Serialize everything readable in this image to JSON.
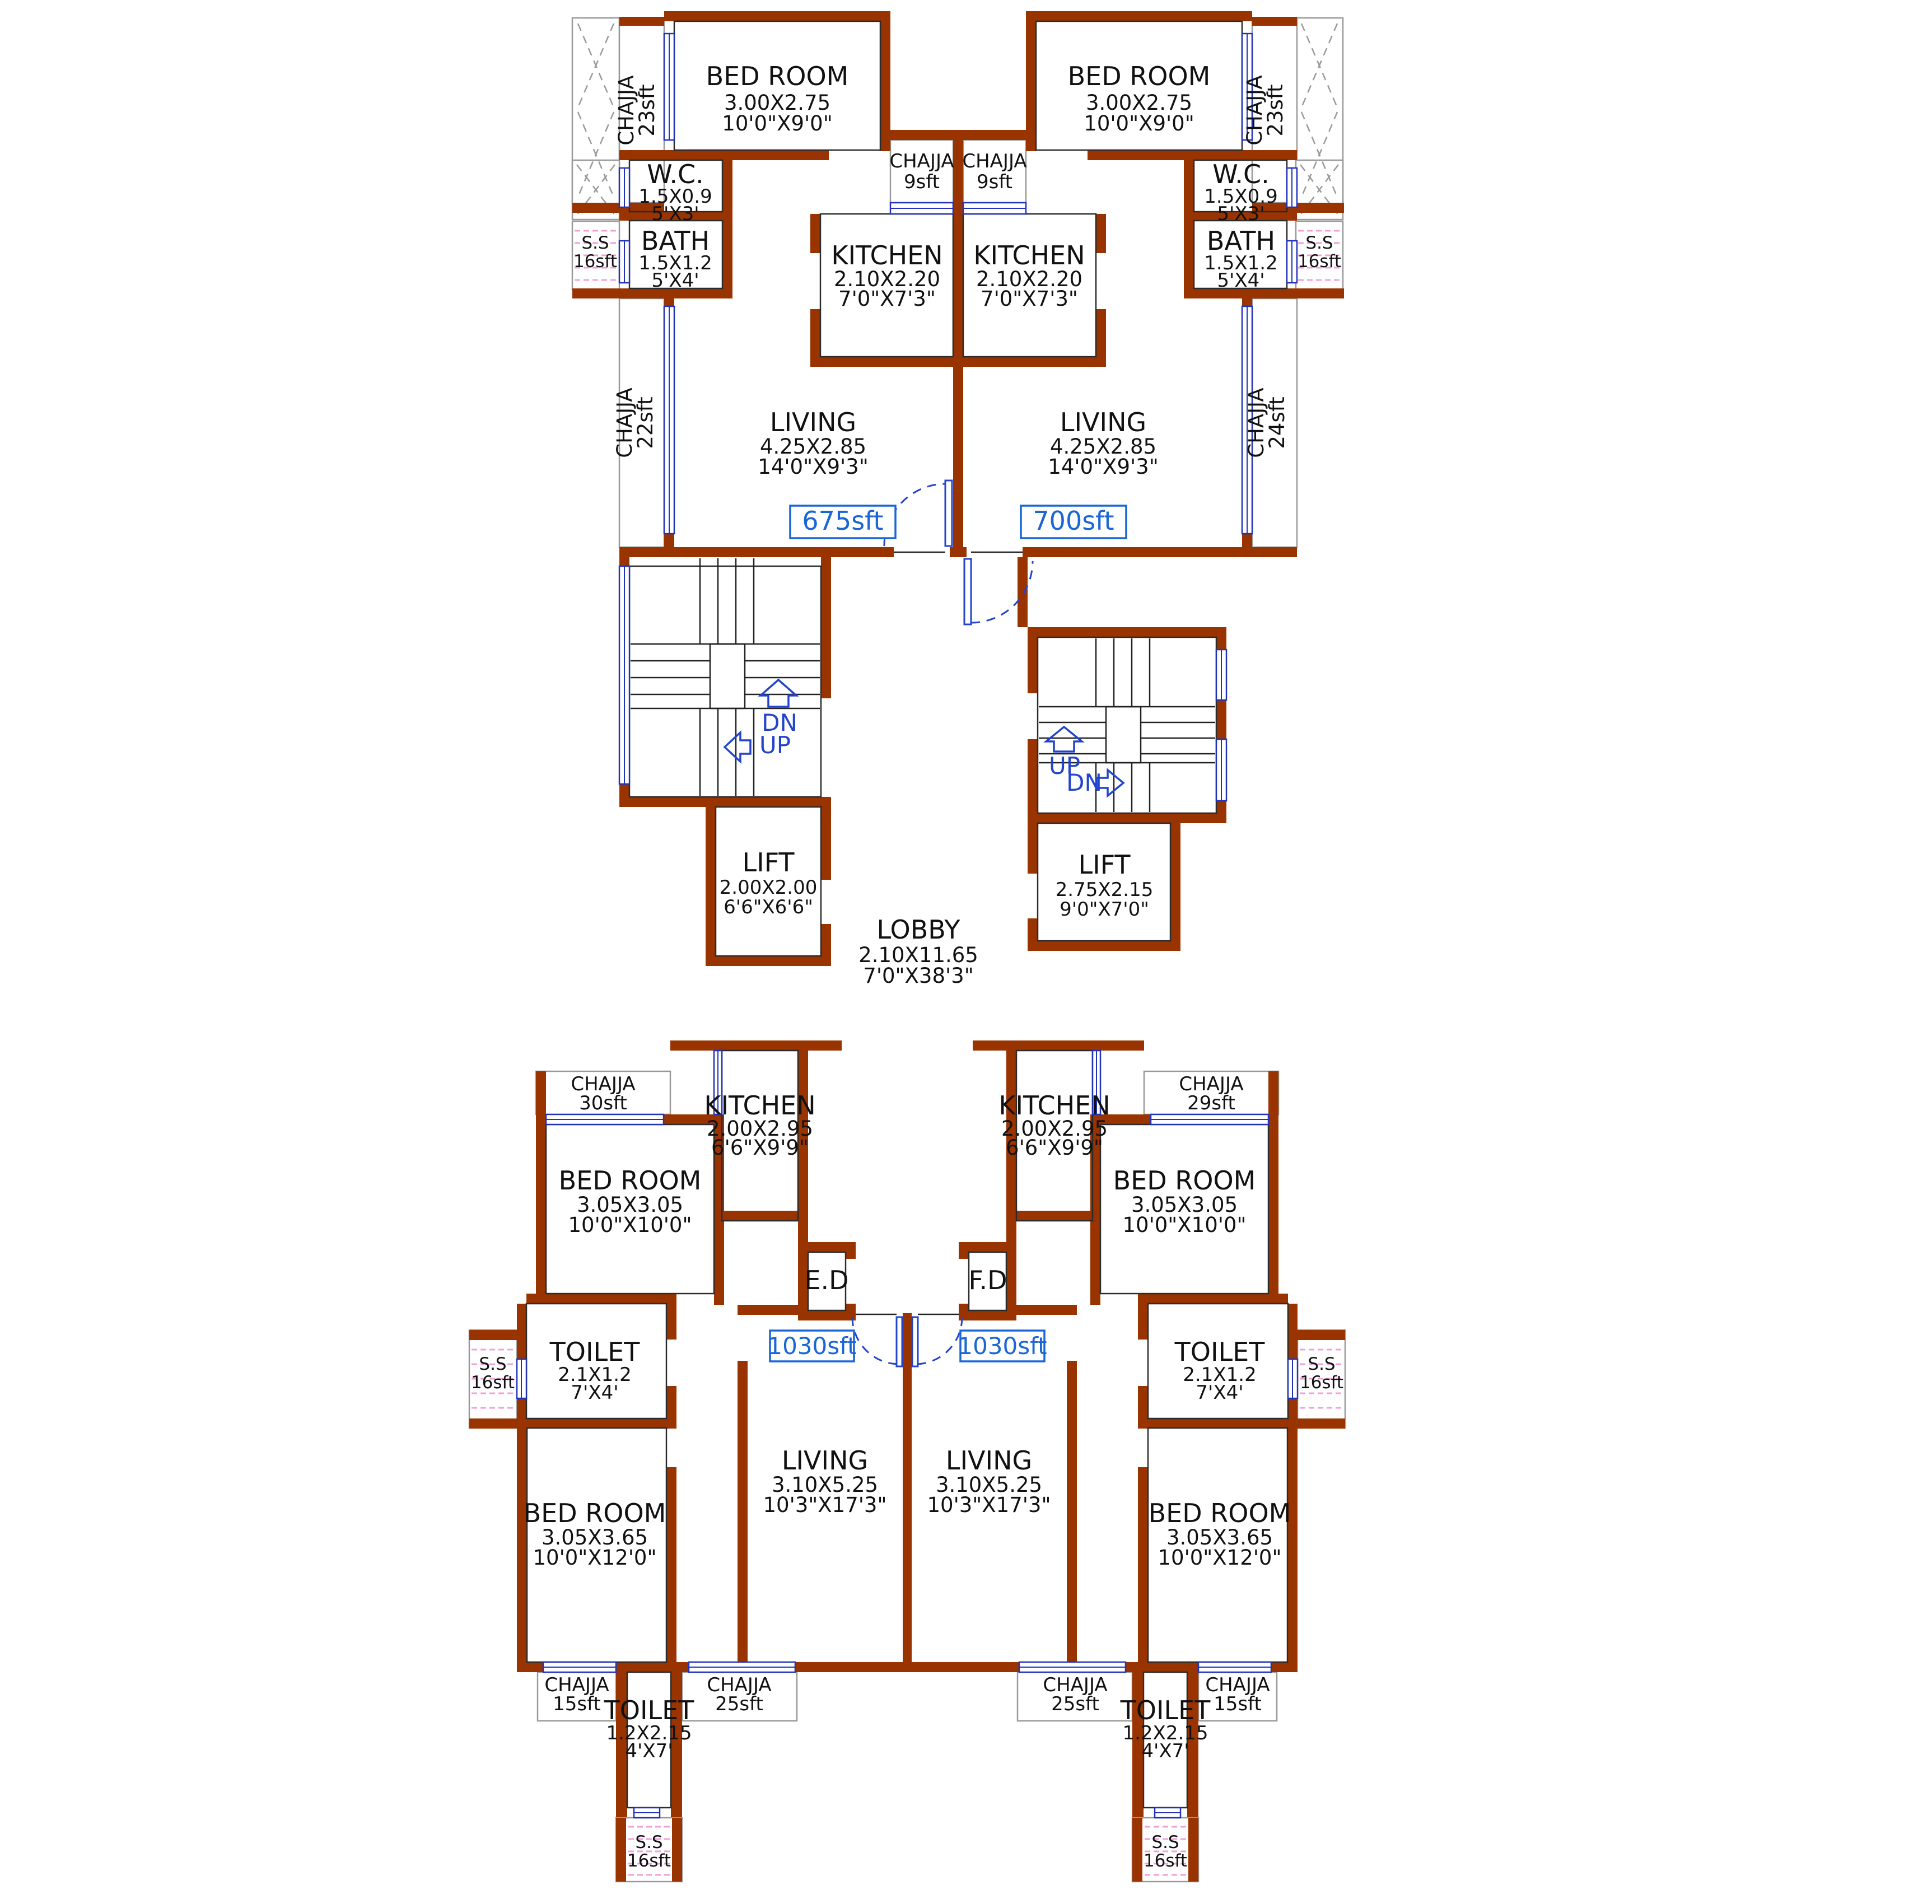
{
  "units": {
    "top_left": {
      "area": "675sft",
      "bedroom": {
        "name": "BED ROOM",
        "m": "3.00X2.75",
        "ft": "10'0\"X9'0\""
      },
      "wc": {
        "name": "W.C.",
        "m": "1.5X0.9",
        "ft": "5'X3'"
      },
      "bath": {
        "name": "BATH",
        "m": "1.5X1.2",
        "ft": "5'X4'"
      },
      "kitchen": {
        "name": "KITCHEN",
        "m": "2.10X2.20",
        "ft": "7'0\"X7'3\""
      },
      "living": {
        "name": "LIVING",
        "m": "4.25X2.85",
        "ft": "14'0\"X9'3\""
      },
      "balcony_chajja": {
        "name": "CHAJJA",
        "area": "23sft"
      },
      "kitchen_chajja": {
        "name": "CHAJJA",
        "area": "9sft"
      },
      "living_chajja": {
        "name": "CHAJJA",
        "area": "22sft"
      },
      "ss": {
        "name": "S.S",
        "area": "16sft"
      }
    },
    "top_right": {
      "area": "700sft",
      "bedroom": {
        "name": "BED ROOM",
        "m": "3.00X2.75",
        "ft": "10'0\"X9'0\""
      },
      "wc": {
        "name": "W.C.",
        "m": "1.5X0.9",
        "ft": "5'X3'"
      },
      "bath": {
        "name": "BATH",
        "m": "1.5X1.2",
        "ft": "5'X4'"
      },
      "kitchen": {
        "name": "KITCHEN",
        "m": "2.10X2.20",
        "ft": "7'0\"X7'3\""
      },
      "living": {
        "name": "LIVING",
        "m": "4.25X2.85",
        "ft": "14'0\"X9'3\""
      },
      "balcony_chajja": {
        "name": "CHAJJA",
        "area": "23sft"
      },
      "kitchen_chajja": {
        "name": "CHAJJA",
        "area": "9sft"
      },
      "living_chajja": {
        "name": "CHAJJA",
        "area": "24sft"
      },
      "ss": {
        "name": "S.S",
        "area": "16sft"
      }
    },
    "bottom_left": {
      "area": "1030sft",
      "duct": "E.D",
      "kitchen": {
        "name": "KITCHEN",
        "m": "2.00X2.95",
        "ft": "6'6\"X9'9\""
      },
      "bedroom1": {
        "name": "BED ROOM",
        "m": "3.05X3.05",
        "ft": "10'0\"X10'0\""
      },
      "bedroom2": {
        "name": "BED ROOM",
        "m": "3.05X3.65",
        "ft": "10'0\"X12'0\""
      },
      "toilet1": {
        "name": "TOILET",
        "m": "2.1X1.2",
        "ft": "7'X4'"
      },
      "toilet2": {
        "name": "TOILET",
        "m": "1.2X2.15",
        "ft": "4'X7'"
      },
      "living": {
        "name": "LIVING",
        "m": "3.10X5.25",
        "ft": "10'3\"X17'3\""
      },
      "top_chajja": {
        "name": "CHAJJA",
        "area": "30sft"
      },
      "outer_chajja": {
        "name": "CHAJJA",
        "area": "15sft"
      },
      "inner_chajja": {
        "name": "CHAJJA",
        "area": "25sft"
      },
      "side_ss": {
        "name": "S.S",
        "area": "16sft"
      },
      "bottom_ss": {
        "name": "S.S",
        "area": "16sft"
      }
    },
    "bottom_right": {
      "area": "1030sft",
      "duct": "F.D",
      "kitchen": {
        "name": "KITCHEN",
        "m": "2.00X2.95",
        "ft": "6'6\"X9'9\""
      },
      "bedroom1": {
        "name": "BED ROOM",
        "m": "3.05X3.05",
        "ft": "10'0\"X10'0\""
      },
      "bedroom2": {
        "name": "BED ROOM",
        "m": "3.05X3.65",
        "ft": "10'0\"X12'0\""
      },
      "toilet1": {
        "name": "TOILET",
        "m": "2.1X1.2",
        "ft": "7'X4'"
      },
      "toilet2": {
        "name": "TOILET",
        "m": "1.2X2.15",
        "ft": "4'X7'"
      },
      "living": {
        "name": "LIVING",
        "m": "3.10X5.25",
        "ft": "10'3\"X17'3\""
      },
      "top_chajja": {
        "name": "CHAJJA",
        "area": "29sft"
      },
      "outer_chajja": {
        "name": "CHAJJA",
        "area": "15sft"
      },
      "inner_chajja": {
        "name": "CHAJJA",
        "area": "25sft"
      },
      "side_ss": {
        "name": "S.S",
        "area": "16sft"
      },
      "bottom_ss": {
        "name": "S.S",
        "area": "16sft"
      }
    }
  },
  "core": {
    "lift_left": {
      "name": "LIFT",
      "m": "2.00X2.00",
      "ft": "6'6\"X6'6\""
    },
    "lift_right": {
      "name": "LIFT",
      "m": "2.75X2.15",
      "ft": "9'0\"X7'0\""
    },
    "lobby": {
      "name": "LOBBY",
      "m": "2.10X11.65",
      "ft": "7'0\"X38'3\""
    },
    "stairs_left": {
      "up": "UP",
      "dn": "DN"
    },
    "stairs_right": {
      "up": "UP",
      "dn": "DN"
    }
  },
  "colors": {
    "wall": "#993300",
    "window": "#2233bb",
    "label_blue": "#1a66d6",
    "nav_blue": "#2244cc",
    "tile_pink": "#f2a0d8"
  }
}
